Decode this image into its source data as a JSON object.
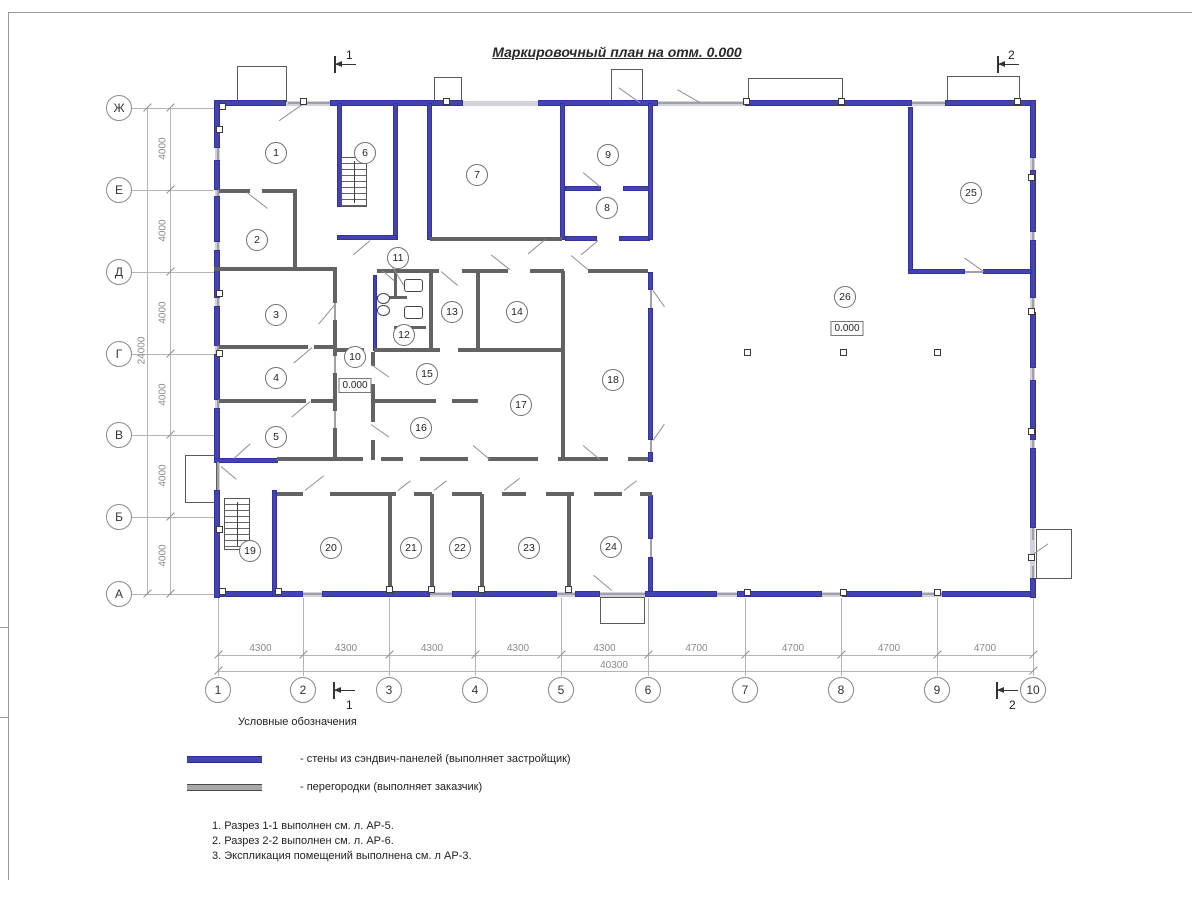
{
  "title": "Маркировочный план на отм. 0.000",
  "grid": {
    "rows": [
      {
        "label": "Ж",
        "y": 108
      },
      {
        "label": "Е",
        "y": 190
      },
      {
        "label": "Д",
        "y": 272
      },
      {
        "label": "Г",
        "y": 354
      },
      {
        "label": "В",
        "y": 435
      },
      {
        "label": "Б",
        "y": 517
      },
      {
        "label": "А",
        "y": 594
      }
    ],
    "cols": [
      {
        "label": "1",
        "x": 218
      },
      {
        "label": "2",
        "x": 303
      },
      {
        "label": "3",
        "x": 389
      },
      {
        "label": "4",
        "x": 475
      },
      {
        "label": "5",
        "x": 561
      },
      {
        "label": "6",
        "x": 648
      },
      {
        "label": "7",
        "x": 745
      },
      {
        "label": "8",
        "x": 841
      },
      {
        "label": "9",
        "x": 937
      },
      {
        "label": "10",
        "x": 1033
      }
    ],
    "row_dims": [
      "4000",
      "4000",
      "4000",
      "4000",
      "4000",
      "4000"
    ],
    "row_total": "24000",
    "col_dims": [
      "4300",
      "4300",
      "4300",
      "4300",
      "4300",
      "4700",
      "4700",
      "4700",
      "4700"
    ],
    "col_total": "40300"
  },
  "rooms": [
    {
      "n": "1",
      "x": 276,
      "y": 153
    },
    {
      "n": "2",
      "x": 257,
      "y": 240
    },
    {
      "n": "3",
      "x": 276,
      "y": 315
    },
    {
      "n": "4",
      "x": 276,
      "y": 378
    },
    {
      "n": "5",
      "x": 276,
      "y": 437
    },
    {
      "n": "6",
      "x": 365,
      "y": 153
    },
    {
      "n": "7",
      "x": 477,
      "y": 175
    },
    {
      "n": "8",
      "x": 607,
      "y": 208
    },
    {
      "n": "9",
      "x": 608,
      "y": 155
    },
    {
      "n": "10",
      "x": 355,
      "y": 357
    },
    {
      "n": "11",
      "x": 398,
      "y": 258
    },
    {
      "n": "12",
      "x": 404,
      "y": 335
    },
    {
      "n": "13",
      "x": 452,
      "y": 312
    },
    {
      "n": "14",
      "x": 517,
      "y": 312
    },
    {
      "n": "15",
      "x": 427,
      "y": 374
    },
    {
      "n": "16",
      "x": 421,
      "y": 428
    },
    {
      "n": "17",
      "x": 521,
      "y": 405
    },
    {
      "n": "18",
      "x": 613,
      "y": 380
    },
    {
      "n": "19",
      "x": 250,
      "y": 551
    },
    {
      "n": "20",
      "x": 331,
      "y": 548
    },
    {
      "n": "21",
      "x": 411,
      "y": 548
    },
    {
      "n": "22",
      "x": 460,
      "y": 548
    },
    {
      "n": "23",
      "x": 529,
      "y": 548
    },
    {
      "n": "24",
      "x": 611,
      "y": 547
    },
    {
      "n": "25",
      "x": 971,
      "y": 193
    },
    {
      "n": "26",
      "x": 845,
      "y": 297
    }
  ],
  "elevations": [
    {
      "text": "0.000",
      "x": 355,
      "y": 378
    },
    {
      "text": "0.000",
      "x": 847,
      "y": 321
    }
  ],
  "section_markers": [
    {
      "label": "1",
      "x": 334,
      "y": 56,
      "lx": 12,
      "ly": -8
    },
    {
      "label": "2",
      "x": 997,
      "y": 56,
      "lx": 11,
      "ly": -8
    },
    {
      "label": "1",
      "x": 333,
      "y": 682,
      "lx": 13,
      "ly": 16
    },
    {
      "label": "2",
      "x": 996,
      "y": 682,
      "lx": 13,
      "ly": 16
    }
  ],
  "legend": {
    "heading": "Условные обозначения",
    "items": [
      {
        "swatch": "#4444b0",
        "border": "#2c2c92",
        "label": "- стены из сэндвич-панелей (выполняет застройщик)"
      },
      {
        "swatch": "#a8a8a8",
        "border": "#4a4a4a",
        "label": "- перегородки (выполняет заказчик)"
      }
    ]
  },
  "notes": [
    "1. Разрез 1-1 выполнен см. л. АР-5.",
    "2. Разрез 2-2 выполнен см. л. АР-6.",
    "3. Экспликация помещений выполнена см. л АР-3."
  ],
  "colors": {
    "sandwich_wall": "#4444b0",
    "partition": "#636363",
    "infill": "#d2d2da",
    "lines": "#8a8a8a"
  },
  "plan": {
    "bases": [
      [
        218,
        101,
        815,
        5
      ],
      [
        218,
        592,
        815,
        5
      ],
      [
        215,
        101,
        5,
        496
      ],
      [
        1030,
        101,
        5,
        496
      ]
    ],
    "walls_blue": [
      [
        218,
        100,
        68,
        6
      ],
      [
        330,
        100,
        133,
        6
      ],
      [
        538,
        100,
        120,
        6
      ],
      [
        745,
        100,
        167,
        6
      ],
      [
        945,
        100,
        88,
        6
      ],
      [
        218,
        591,
        85,
        6
      ],
      [
        322,
        591,
        108,
        6
      ],
      [
        452,
        591,
        105,
        6
      ],
      [
        575,
        591,
        25,
        6
      ],
      [
        645,
        591,
        72,
        6
      ],
      [
        737,
        591,
        85,
        6
      ],
      [
        842,
        591,
        80,
        6
      ],
      [
        942,
        591,
        91,
        6
      ],
      [
        214,
        100,
        6,
        48
      ],
      [
        214,
        160,
        6,
        30
      ],
      [
        214,
        196,
        6,
        46
      ],
      [
        214,
        250,
        6,
        48
      ],
      [
        214,
        306,
        6,
        40
      ],
      [
        214,
        354,
        6,
        46
      ],
      [
        214,
        408,
        6,
        52
      ],
      [
        214,
        490,
        6,
        108
      ],
      [
        1030,
        100,
        6,
        58
      ],
      [
        1030,
        170,
        6,
        62
      ],
      [
        1030,
        240,
        6,
        58
      ],
      [
        1030,
        312,
        6,
        56
      ],
      [
        1030,
        380,
        6,
        60
      ],
      [
        1030,
        448,
        6,
        80
      ],
      [
        1030,
        578,
        6,
        20
      ],
      [
        337,
        103,
        5,
        104
      ],
      [
        393,
        103,
        5,
        137
      ],
      [
        337,
        235,
        60,
        5
      ],
      [
        427,
        103,
        5,
        137
      ],
      [
        560,
        103,
        5,
        137
      ],
      [
        565,
        186,
        36,
        5
      ],
      [
        623,
        186,
        27,
        5
      ],
      [
        565,
        236,
        32,
        5
      ],
      [
        619,
        236,
        31,
        5
      ],
      [
        648,
        103,
        5,
        137
      ],
      [
        648,
        272,
        5,
        18
      ],
      [
        648,
        308,
        5,
        132
      ],
      [
        648,
        452,
        5,
        10
      ],
      [
        648,
        495,
        5,
        44
      ],
      [
        648,
        557,
        5,
        35
      ],
      [
        908,
        107,
        5,
        167
      ],
      [
        908,
        269,
        57,
        5
      ],
      [
        983,
        269,
        49,
        5
      ],
      [
        272,
        490,
        5,
        107
      ],
      [
        214,
        458,
        64,
        5
      ],
      [
        373,
        275,
        4,
        76
      ]
    ],
    "walls_gray": [
      [
        218,
        189,
        32,
        4
      ],
      [
        262,
        189,
        35,
        4
      ],
      [
        293,
        189,
        4,
        81
      ],
      [
        214,
        267,
        123,
        4
      ],
      [
        333,
        267,
        4,
        36
      ],
      [
        333,
        320,
        4,
        36
      ],
      [
        333,
        373,
        4,
        38
      ],
      [
        333,
        428,
        4,
        32
      ],
      [
        218,
        345,
        90,
        4
      ],
      [
        314,
        345,
        20,
        4
      ],
      [
        218,
        399,
        88,
        4
      ],
      [
        311,
        399,
        23,
        4
      ],
      [
        377,
        269,
        62,
        4
      ],
      [
        462,
        269,
        46,
        4
      ],
      [
        530,
        269,
        34,
        4
      ],
      [
        588,
        269,
        60,
        4
      ],
      [
        429,
        271,
        4,
        79
      ],
      [
        476,
        271,
        4,
        79
      ],
      [
        561,
        271,
        4,
        189
      ],
      [
        336,
        348,
        28,
        4
      ],
      [
        374,
        348,
        66,
        4
      ],
      [
        458,
        348,
        104,
        4
      ],
      [
        371,
        352,
        4,
        14
      ],
      [
        371,
        384,
        4,
        38
      ],
      [
        371,
        440,
        4,
        20
      ],
      [
        374,
        399,
        62,
        4
      ],
      [
        452,
        399,
        26,
        4
      ],
      [
        430,
        237,
        132,
        4
      ],
      [
        277,
        457,
        60,
        4
      ],
      [
        337,
        457,
        26,
        4
      ],
      [
        381,
        457,
        22,
        4
      ],
      [
        420,
        457,
        48,
        4
      ],
      [
        488,
        457,
        50,
        4
      ],
      [
        558,
        457,
        50,
        4
      ],
      [
        628,
        457,
        20,
        4
      ],
      [
        277,
        492,
        26,
        4
      ],
      [
        330,
        492,
        66,
        4
      ],
      [
        414,
        492,
        18,
        4
      ],
      [
        452,
        492,
        30,
        4
      ],
      [
        502,
        492,
        24,
        4
      ],
      [
        546,
        492,
        28,
        4
      ],
      [
        594,
        492,
        28,
        4
      ],
      [
        640,
        492,
        12,
        4
      ],
      [
        388,
        494,
        4,
        99
      ],
      [
        430,
        494,
        4,
        99
      ],
      [
        480,
        494,
        4,
        99
      ],
      [
        567,
        494,
        4,
        99
      ],
      [
        394,
        271,
        3,
        28
      ],
      [
        377,
        296,
        30,
        3
      ],
      [
        394,
        326,
        32,
        3
      ]
    ],
    "walls_thin": [
      [
        288,
        102,
        42,
        1.5
      ],
      [
        658,
        102,
        87,
        1.5
      ],
      [
        912,
        102,
        33,
        1.5
      ],
      [
        303,
        593,
        19,
        1.5
      ],
      [
        430,
        593,
        22,
        1.5
      ],
      [
        557,
        593,
        18,
        1.5
      ],
      [
        717,
        593,
        20,
        1.5
      ],
      [
        822,
        593,
        20,
        1.5
      ],
      [
        922,
        593,
        20,
        1.5
      ],
      [
        600,
        593,
        45,
        1.5
      ],
      [
        217,
        148,
        1.5,
        12
      ],
      [
        217,
        190,
        1.5,
        6
      ],
      [
        217,
        242,
        1.5,
        8
      ],
      [
        217,
        298,
        1.5,
        8
      ],
      [
        217,
        346,
        1.5,
        8
      ],
      [
        217,
        400,
        1.5,
        8
      ],
      [
        217,
        462,
        1.5,
        28
      ],
      [
        1032,
        158,
        1.5,
        12
      ],
      [
        1032,
        232,
        1.5,
        8
      ],
      [
        1032,
        298,
        1.5,
        14
      ],
      [
        1032,
        368,
        1.5,
        12
      ],
      [
        1032,
        440,
        1.5,
        8
      ],
      [
        1032,
        528,
        1.5,
        12
      ],
      [
        1032,
        566,
        1.5,
        12
      ],
      [
        334,
        303,
        1.5,
        17
      ],
      [
        334,
        356,
        1.5,
        17
      ],
      [
        334,
        411,
        1.5,
        17
      ],
      [
        650,
        290,
        1.5,
        18
      ],
      [
        650,
        440,
        1.5,
        12
      ],
      [
        650,
        539,
        1.5,
        18
      ],
      [
        965,
        271,
        18,
        1.5
      ]
    ],
    "porches": [
      [
        237,
        66,
        50,
        36
      ],
      [
        434,
        77,
        28,
        25
      ],
      [
        611,
        69,
        32,
        33
      ],
      [
        748,
        78,
        95,
        24
      ],
      [
        947,
        76,
        73,
        26
      ],
      [
        185,
        455,
        32,
        48
      ],
      [
        1036,
        529,
        36,
        50
      ],
      [
        600,
        597,
        45,
        27
      ]
    ],
    "columns": [
      [
        300,
        98
      ],
      [
        443,
        98
      ],
      [
        743,
        98
      ],
      [
        838,
        98
      ],
      [
        1014,
        98
      ],
      [
        219,
        103
      ],
      [
        744,
        349
      ],
      [
        840,
        349
      ],
      [
        934,
        349
      ],
      [
        744,
        589
      ],
      [
        840,
        589
      ],
      [
        934,
        589
      ],
      [
        386,
        586
      ],
      [
        428,
        586
      ],
      [
        478,
        586
      ],
      [
        565,
        586
      ],
      [
        275,
        588
      ],
      [
        219,
        588
      ],
      [
        216,
        126
      ],
      [
        216,
        290
      ],
      [
        216,
        350
      ],
      [
        216,
        526
      ],
      [
        1028,
        174
      ],
      [
        1028,
        308
      ],
      [
        1028,
        428
      ],
      [
        1028,
        554
      ]
    ],
    "doors": [
      [
        302,
        104,
        28,
        145
      ],
      [
        640,
        102,
        26,
        -145
      ],
      [
        700,
        102,
        26,
        -150
      ],
      [
        247,
        192,
        26,
        38
      ],
      [
        334,
        305,
        24,
        130
      ],
      [
        312,
        347,
        24,
        140
      ],
      [
        310,
        401,
        24,
        140
      ],
      [
        371,
        364,
        22,
        35
      ],
      [
        371,
        424,
        22,
        35
      ],
      [
        441,
        271,
        22,
        40
      ],
      [
        510,
        269,
        24,
        -142
      ],
      [
        588,
        269,
        22,
        -140
      ],
      [
        490,
        459,
        22,
        -140
      ],
      [
        600,
        459,
        22,
        -140
      ],
      [
        653,
        290,
        20,
        55
      ],
      [
        653,
        440,
        20,
        -55
      ],
      [
        600,
        186,
        22,
        -140
      ],
      [
        598,
        240,
        22,
        140
      ],
      [
        545,
        239,
        22,
        140
      ],
      [
        984,
        271,
        24,
        -145
      ],
      [
        305,
        490,
        24,
        -38
      ],
      [
        398,
        490,
        16,
        -38
      ],
      [
        434,
        490,
        16,
        -38
      ],
      [
        504,
        490,
        20,
        -38
      ],
      [
        624,
        490,
        16,
        -38
      ],
      [
        234,
        458,
        22,
        -42
      ],
      [
        221,
        466,
        20,
        40
      ],
      [
        1030,
        556,
        22,
        -35
      ],
      [
        612,
        590,
        24,
        -140
      ],
      [
        370,
        240,
        22,
        140
      ],
      [
        382,
        270,
        16,
        40
      ],
      [
        392,
        266,
        22,
        58
      ]
    ],
    "stairs": [
      [
        341,
        157,
        26,
        50
      ],
      [
        224,
        498,
        26,
        52
      ]
    ],
    "toilets": [
      [
        404,
        279,
        17,
        11
      ],
      [
        404,
        306,
        17,
        11
      ]
    ],
    "sinks": [
      [
        377,
        293,
        11,
        9
      ],
      [
        377,
        305,
        11,
        9
      ]
    ]
  }
}
